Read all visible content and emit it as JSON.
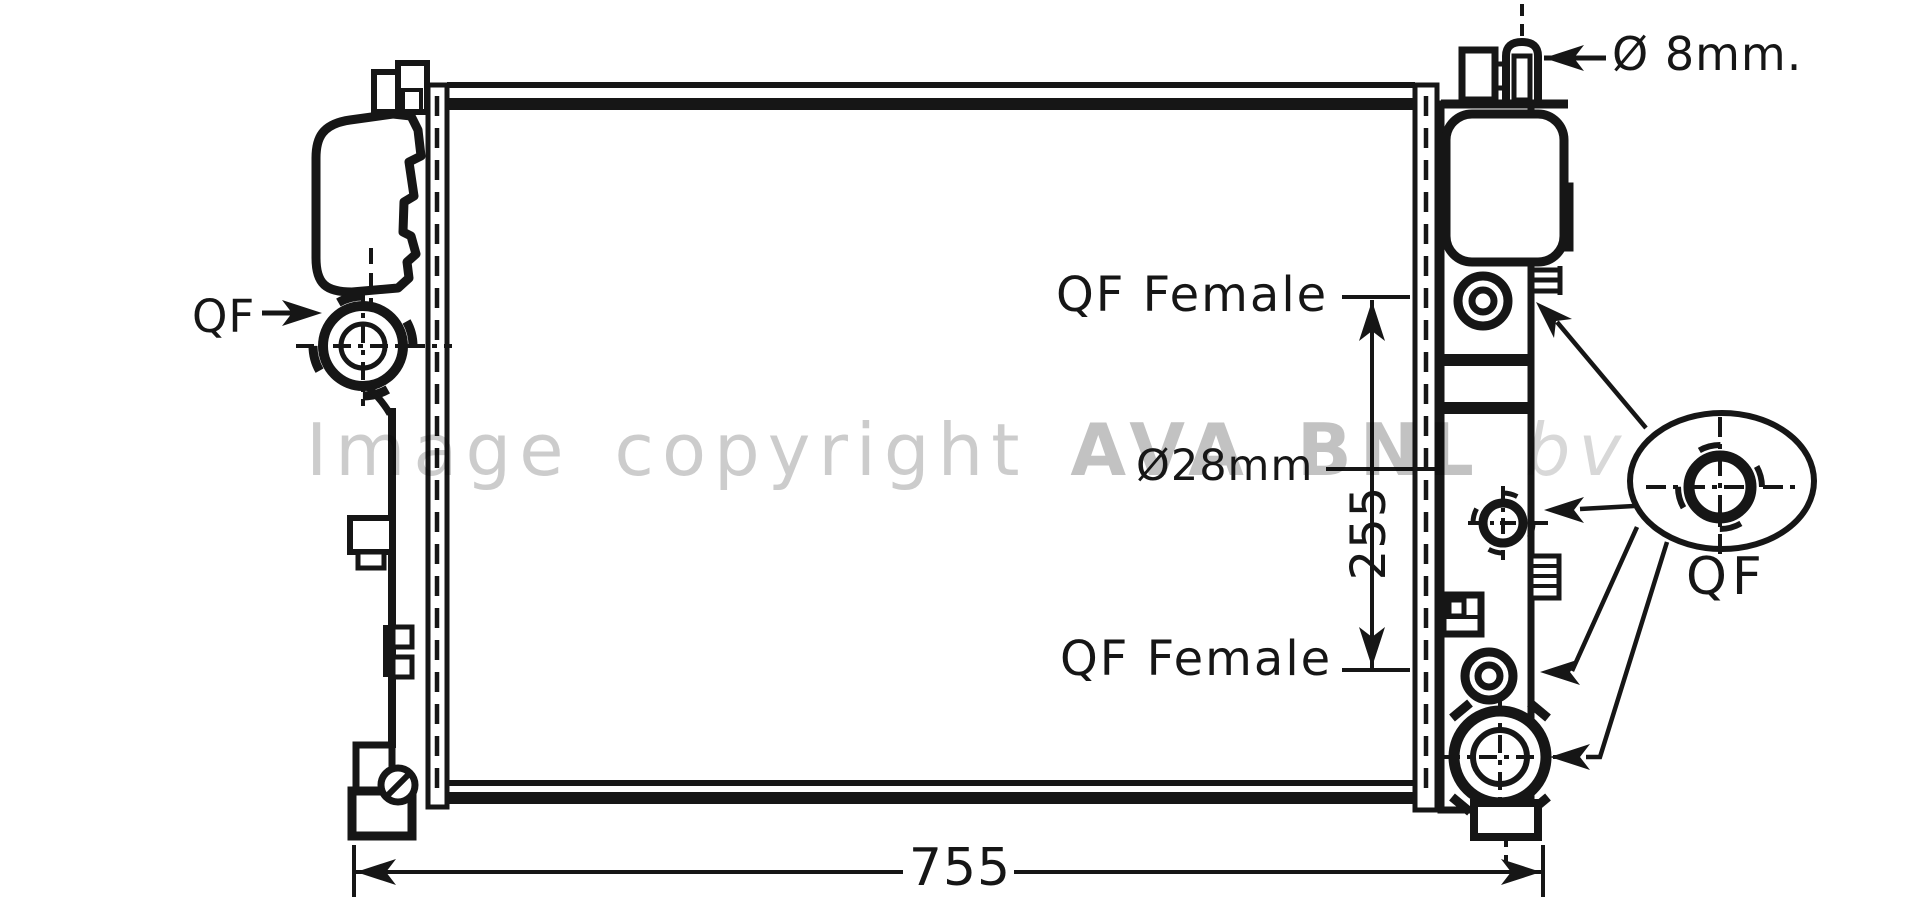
{
  "page": {
    "background": "#ffffff",
    "line_color": "#161616",
    "watermark_color": "#c7c7c7"
  },
  "labels": {
    "left_connector": "QF",
    "filler_diameter": "Ø 8mm.",
    "upper_port": "QF Female",
    "lower_port": "QF Female",
    "port_diameter": "Ø28mm",
    "port_spacing": "255",
    "core_width": "755",
    "callout_connector": "QF"
  },
  "watermark": {
    "prefix": "Image copyright ",
    "brand": "AVA BNL",
    "suffix": " bv"
  }
}
